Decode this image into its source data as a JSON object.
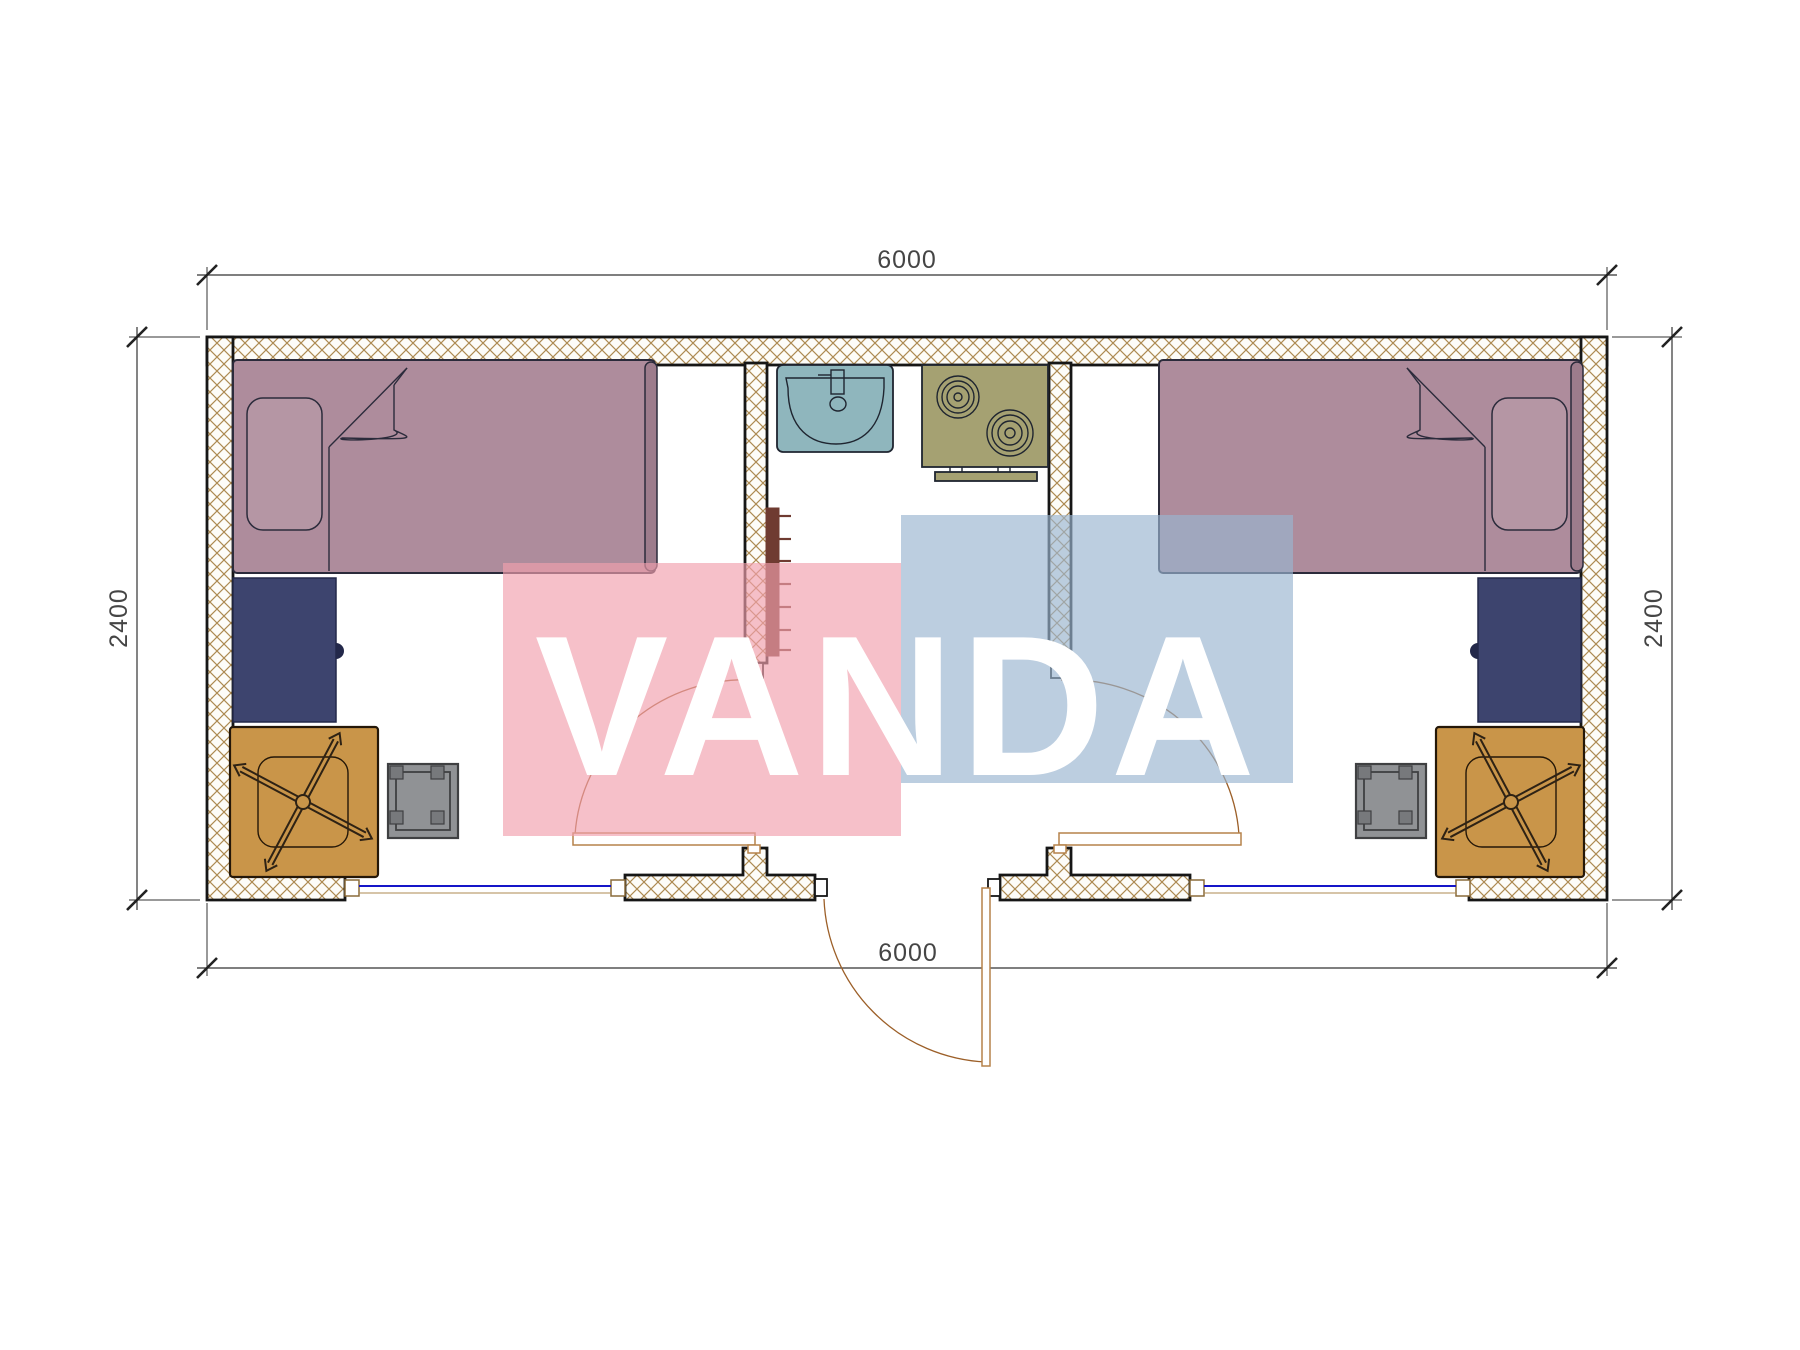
{
  "dimensions": {
    "top": "6000",
    "bottom": "6000",
    "left": "2400",
    "right": "2400"
  },
  "watermark": {
    "text": "VANDA"
  },
  "colors": {
    "wall_hatch": "#ad8a52",
    "wall_bg": "#fdfcf8",
    "wall_stroke": "#161616",
    "dim_line": "#333333",
    "dim_tick": "#222222",
    "dim_text": "#454545",
    "bed_fill": "#ae8c9c",
    "pillow_fill": "#b596a4",
    "footboard_fill": "#9d7c8c",
    "bed_stroke": "#2b2b3b",
    "desk_fill": "#3d446e",
    "desk_stroke": "#23284a",
    "table_fill": "#c99549",
    "table_stroke": "#241708",
    "chair_stroke": "#2e2214",
    "stool_fill": "#909295",
    "stool_stroke": "#3f4042",
    "stool_corner": "#77797c",
    "sink_fill": "#8fb6bd",
    "stove_fill": "#a5a172",
    "fixture_stroke": "#1f2530",
    "radiator_fill": "#6f3b31",
    "window_glass": "#1515c8",
    "window_frame": "#8a6b3a",
    "door_stroke": "#9c5f28",
    "door_leaf_stroke": "#b5824a",
    "wm_pink": "rgba(242,160,173,0.66)",
    "wm_blue": "rgba(154,180,208,0.66)",
    "wm_text": "#ffffff"
  }
}
